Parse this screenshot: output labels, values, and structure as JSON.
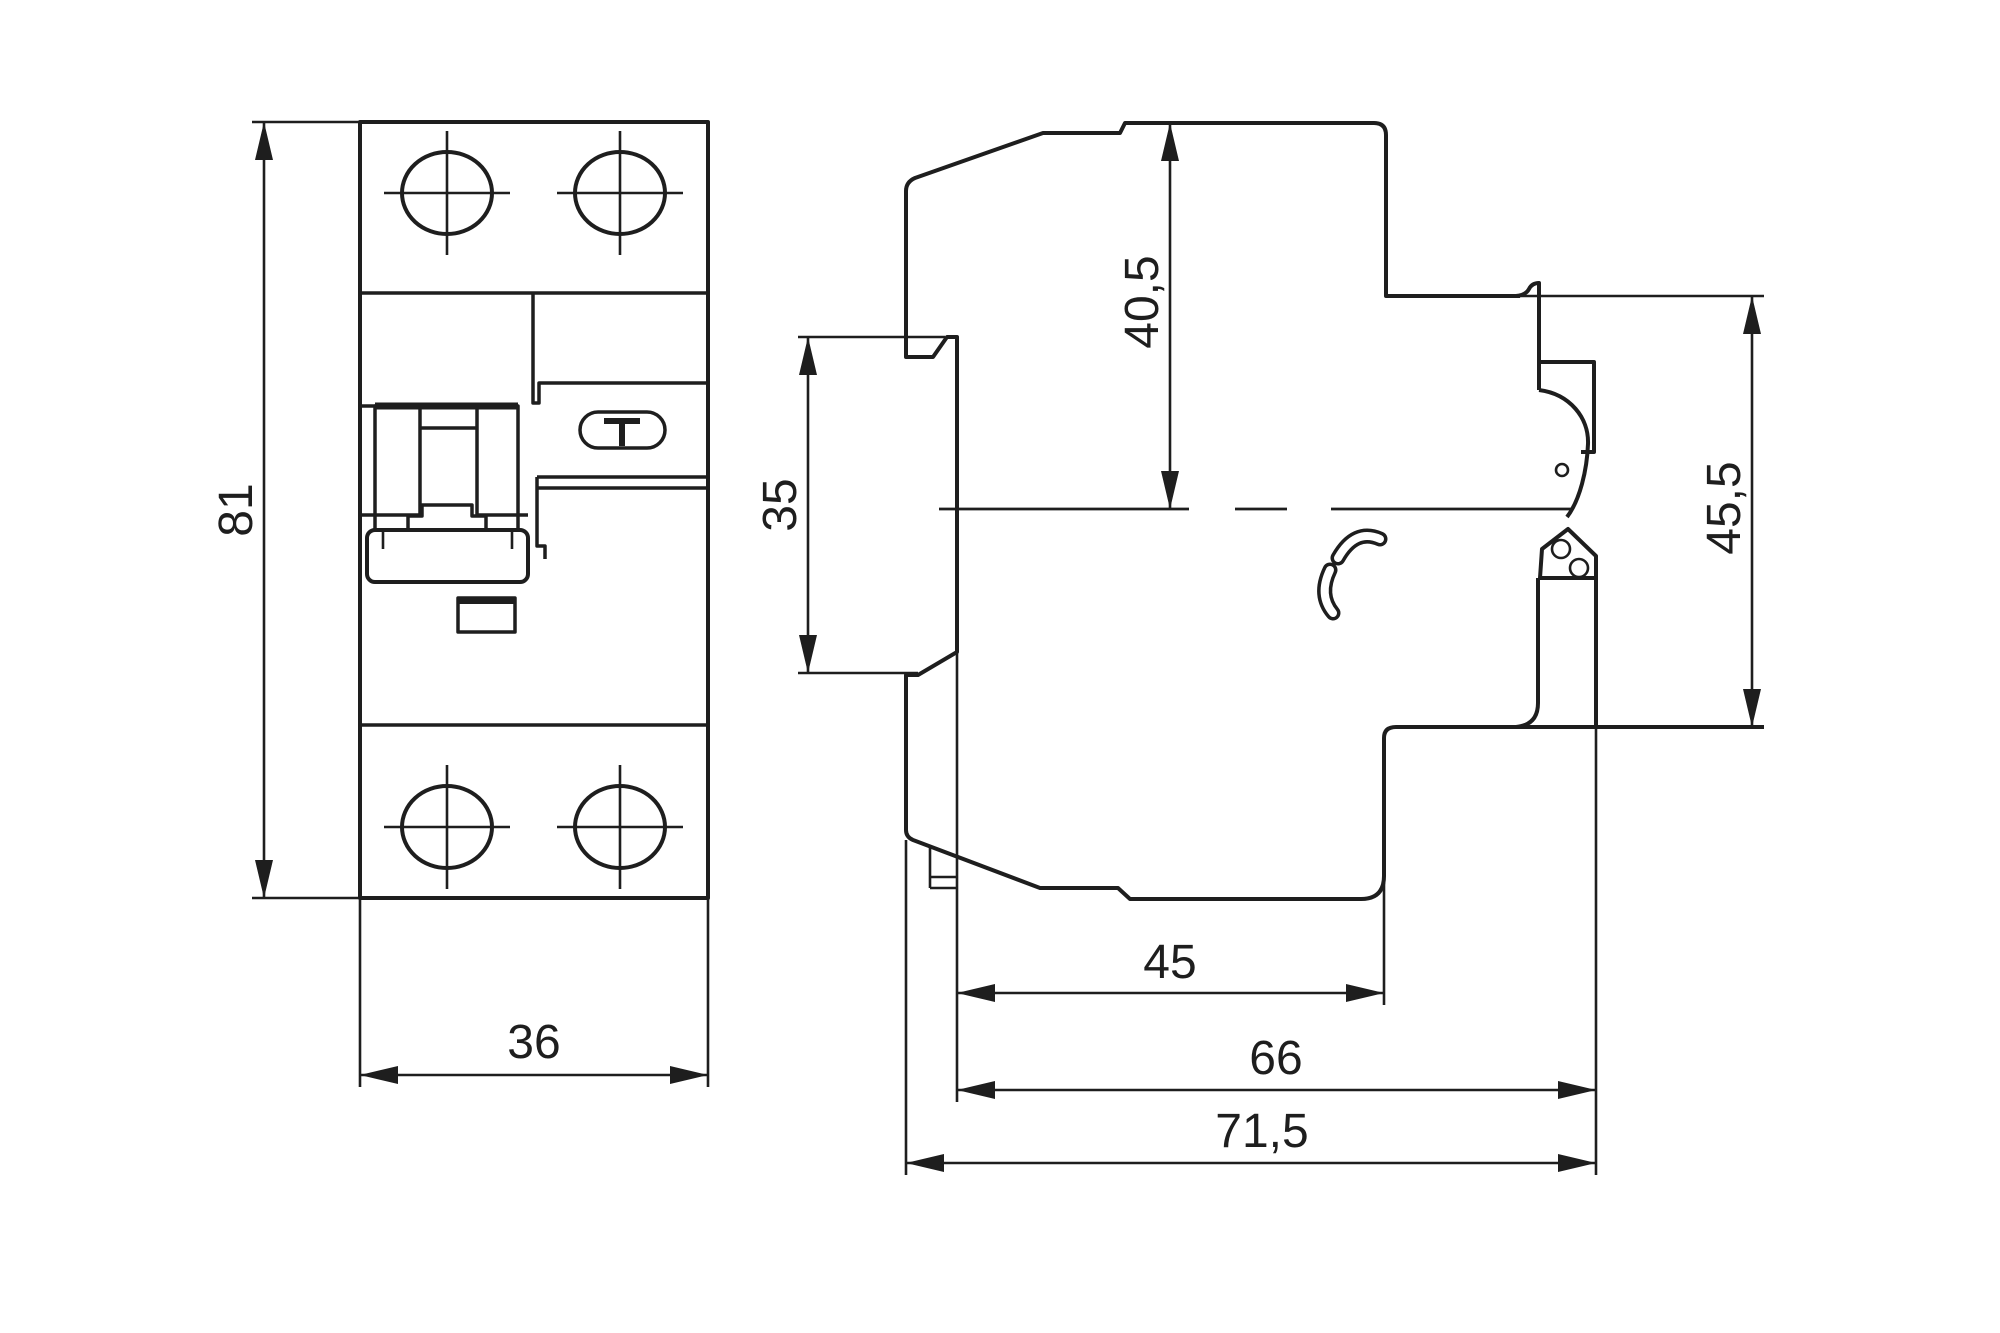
{
  "front_view": {
    "test_button_label": "T"
  },
  "dimensions": {
    "height": {
      "value": "81",
      "orientation": "vertical",
      "applies_to": "front-view-overall-height"
    },
    "width": {
      "value": "36",
      "orientation": "horizontal",
      "applies_to": "front-view-overall-width"
    },
    "depth_to_center": {
      "value": "40,5",
      "orientation": "vertical",
      "applies_to": "side-view-top-to-rail-center"
    },
    "din_rail": {
      "value": "35",
      "orientation": "vertical",
      "applies_to": "side-view-din-rail-claw-opening"
    },
    "depth_lower": {
      "value": "45",
      "orientation": "horizontal",
      "applies_to": "side-view-lower-body-depth"
    },
    "depth_mid": {
      "value": "66",
      "orientation": "horizontal",
      "applies_to": "side-view-body-depth-with-clip"
    },
    "depth_total": {
      "value": "71,5",
      "orientation": "horizontal",
      "applies_to": "side-view-total-depth"
    },
    "right_height": {
      "value": "45,5",
      "orientation": "vertical",
      "applies_to": "side-view-clip-section-height"
    }
  },
  "colors": {
    "line": "#1e1e1e",
    "background": "#ffffff"
  }
}
